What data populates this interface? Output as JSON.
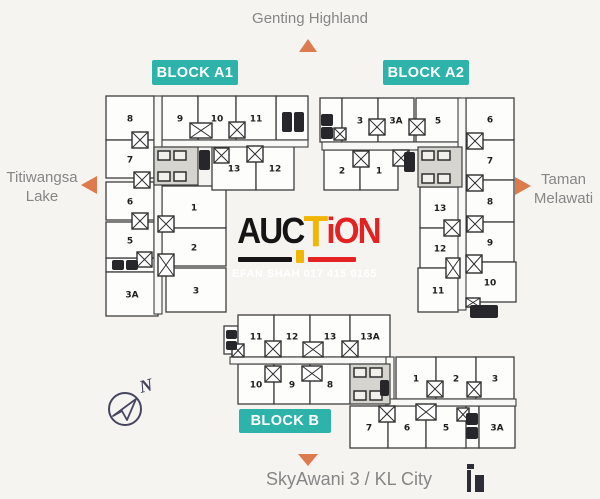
{
  "colors": {
    "teal": "#2db3aa",
    "orange": "#dd7b4e",
    "label": "#868686",
    "navy": "#46455f",
    "icon": "#2d2d38",
    "wmBlack": "#151515",
    "wmGold": "#f2b600",
    "wmRed": "#e42222",
    "bg": "#f5f4f1"
  },
  "landmarks": {
    "top": {
      "label": "Genting Highland"
    },
    "left": {
      "lines": [
        "Titiwangsa",
        "Lake"
      ]
    },
    "right": {
      "lines": [
        "Taman",
        "Melawati"
      ]
    },
    "bottom": {
      "label": "SkyAwani 3 / KL City"
    }
  },
  "compass": {
    "label": "N"
  },
  "watermark": {
    "black": "AUC",
    "gold": "T",
    "red": "iON",
    "subtext": "EFAN SHAH 017 415 0165"
  },
  "blocks": [
    {
      "id": "A1",
      "badge": {
        "label": "BLOCK A1",
        "r": [
          152,
          60,
          86,
          25
        ]
      },
      "units": [
        {
          "n": "8",
          "r": [
            106,
            96,
            48,
            44
          ]
        },
        {
          "n": "7",
          "r": [
            106,
            140,
            48,
            38
          ]
        },
        {
          "n": "6",
          "r": [
            106,
            182,
            48,
            38
          ]
        },
        {
          "n": "5",
          "r": [
            106,
            222,
            48,
            36
          ]
        },
        {
          "n": "3A",
          "r": [
            106,
            272,
            52,
            44
          ]
        },
        {
          "n": "1",
          "r": [
            162,
            186,
            64,
            42
          ]
        },
        {
          "n": "2",
          "r": [
            162,
            228,
            64,
            38
          ]
        },
        {
          "n": "3",
          "r": [
            166,
            268,
            60,
            44
          ]
        },
        {
          "n": "9",
          "r": [
            162,
            96,
            36,
            44
          ]
        },
        {
          "n": "10",
          "r": [
            198,
            96,
            38,
            44
          ]
        },
        {
          "n": "11",
          "r": [
            236,
            96,
            40,
            44
          ]
        },
        {
          "n": "13",
          "r": [
            212,
            146,
            44,
            44
          ]
        },
        {
          "n": "12",
          "r": [
            256,
            146,
            38,
            44
          ]
        }
      ],
      "service": [
        [
          276,
          96,
          32,
          44
        ],
        [
          106,
          258,
          52,
          14
        ]
      ],
      "corridors": [
        [
          154,
          96,
          8,
          218
        ],
        [
          162,
          140,
          146,
          7
        ]
      ],
      "cores": [
        [
          154,
          147,
          44,
          38
        ]
      ],
      "xboxes": [
        [
          132,
          132,
          16,
          16
        ],
        [
          134,
          172,
          16,
          16
        ],
        [
          132,
          213,
          16,
          16
        ],
        [
          137,
          252,
          15,
          15
        ],
        [
          158,
          216,
          16,
          16
        ],
        [
          158,
          254,
          16,
          22
        ],
        [
          190,
          123,
          22,
          15
        ],
        [
          229,
          122,
          16,
          16
        ],
        [
          214,
          148,
          15,
          15
        ],
        [
          247,
          146,
          16,
          16
        ]
      ],
      "lifts": [
        [
          199,
          150,
          11,
          20
        ],
        [
          282,
          112,
          10,
          20
        ],
        [
          294,
          112,
          10,
          20
        ],
        [
          112,
          260,
          12,
          10
        ],
        [
          126,
          260,
          12,
          10
        ]
      ]
    },
    {
      "id": "A2",
      "badge": {
        "label": "BLOCK A2",
        "r": [
          383,
          60,
          86,
          25
        ]
      },
      "units": [
        {
          "n": "3",
          "r": [
            342,
            98,
            36,
            44
          ]
        },
        {
          "n": "3A",
          "r": [
            378,
            98,
            36,
            44
          ]
        },
        {
          "n": "5",
          "r": [
            416,
            98,
            44,
            44
          ]
        },
        {
          "n": "2",
          "r": [
            324,
            150,
            36,
            40
          ]
        },
        {
          "n": "1",
          "r": [
            360,
            150,
            38,
            40
          ]
        },
        {
          "n": "6",
          "r": [
            466,
            98,
            48,
            42
          ]
        },
        {
          "n": "7",
          "r": [
            466,
            140,
            48,
            40
          ]
        },
        {
          "n": "8",
          "r": [
            466,
            180,
            48,
            42
          ]
        },
        {
          "n": "9",
          "r": [
            466,
            222,
            48,
            40
          ]
        },
        {
          "n": "10",
          "r": [
            464,
            262,
            52,
            40
          ]
        },
        {
          "n": "13",
          "r": [
            420,
            187,
            40,
            41
          ]
        },
        {
          "n": "12",
          "r": [
            420,
            228,
            40,
            40
          ]
        },
        {
          "n": "11",
          "r": [
            418,
            268,
            40,
            44
          ]
        }
      ],
      "service": [
        [
          320,
          98,
          22,
          44
        ]
      ],
      "corridors": [
        [
          458,
          98,
          8,
          212
        ],
        [
          322,
          142,
          136,
          8
        ]
      ],
      "cores": [
        [
          418,
          147,
          44,
          40
        ]
      ],
      "xboxes": [
        [
          369,
          119,
          16,
          16
        ],
        [
          409,
          119,
          16,
          16
        ],
        [
          353,
          151,
          16,
          16
        ],
        [
          393,
          150,
          16,
          16
        ],
        [
          334,
          128,
          12,
          12
        ],
        [
          467,
          133,
          16,
          16
        ],
        [
          467,
          175,
          16,
          16
        ],
        [
          467,
          216,
          16,
          16
        ],
        [
          466,
          255,
          16,
          18
        ],
        [
          444,
          220,
          16,
          16
        ],
        [
          446,
          258,
          14,
          20
        ],
        [
          466,
          298,
          14,
          9
        ]
      ],
      "lifts": [
        [
          404,
          152,
          11,
          20
        ],
        [
          321,
          114,
          12,
          12
        ],
        [
          321,
          127,
          12,
          12
        ],
        [
          470,
          305,
          28,
          13
        ]
      ]
    },
    {
      "id": "B",
      "badge": {
        "label": "BLOCK B",
        "r": [
          239,
          409,
          92,
          24
        ]
      },
      "units": [
        {
          "n": "11",
          "r": [
            238,
            315,
            36,
            42
          ]
        },
        {
          "n": "12",
          "r": [
            274,
            315,
            36,
            42
          ]
        },
        {
          "n": "13",
          "r": [
            310,
            315,
            40,
            42
          ]
        },
        {
          "n": "13A",
          "r": [
            350,
            315,
            40,
            42
          ]
        },
        {
          "n": "10",
          "r": [
            238,
            364,
            36,
            40
          ]
        },
        {
          "n": "9",
          "r": [
            274,
            364,
            36,
            40
          ]
        },
        {
          "n": "8",
          "r": [
            310,
            364,
            40,
            40
          ]
        },
        {
          "n": "1",
          "r": [
            396,
            357,
            40,
            42
          ]
        },
        {
          "n": "2",
          "r": [
            436,
            357,
            40,
            42
          ]
        },
        {
          "n": "3",
          "r": [
            476,
            357,
            38,
            42
          ]
        },
        {
          "n": "7",
          "r": [
            350,
            406,
            38,
            42
          ]
        },
        {
          "n": "6",
          "r": [
            388,
            406,
            38,
            42
          ]
        },
        {
          "n": "5",
          "r": [
            426,
            406,
            40,
            42
          ]
        },
        {
          "n": "3A",
          "r": [
            479,
            406,
            36,
            42
          ]
        }
      ],
      "service": [
        [
          224,
          326,
          14,
          28
        ],
        [
          464,
          406,
          15,
          42
        ]
      ],
      "corridors": [
        [
          230,
          357,
          160,
          7
        ],
        [
          386,
          357,
          8,
          49
        ],
        [
          388,
          399,
          128,
          7
        ]
      ],
      "cores": [
        [
          350,
          364,
          40,
          40
        ]
      ],
      "xboxes": [
        [
          232,
          344,
          12,
          13
        ],
        [
          265,
          341,
          16,
          16
        ],
        [
          303,
          342,
          20,
          15
        ],
        [
          342,
          341,
          16,
          16
        ],
        [
          265,
          366,
          16,
          16
        ],
        [
          302,
          366,
          20,
          15
        ],
        [
          427,
          381,
          16,
          16
        ],
        [
          467,
          382,
          14,
          15
        ],
        [
          379,
          406,
          16,
          16
        ],
        [
          416,
          404,
          20,
          16
        ],
        [
          457,
          408,
          12,
          13
        ]
      ],
      "lifts": [
        [
          226,
          330,
          11,
          9
        ],
        [
          226,
          341,
          11,
          9
        ],
        [
          466,
          413,
          12,
          12
        ],
        [
          466,
          427,
          12,
          12
        ],
        [
          380,
          380,
          9,
          16
        ]
      ]
    }
  ]
}
